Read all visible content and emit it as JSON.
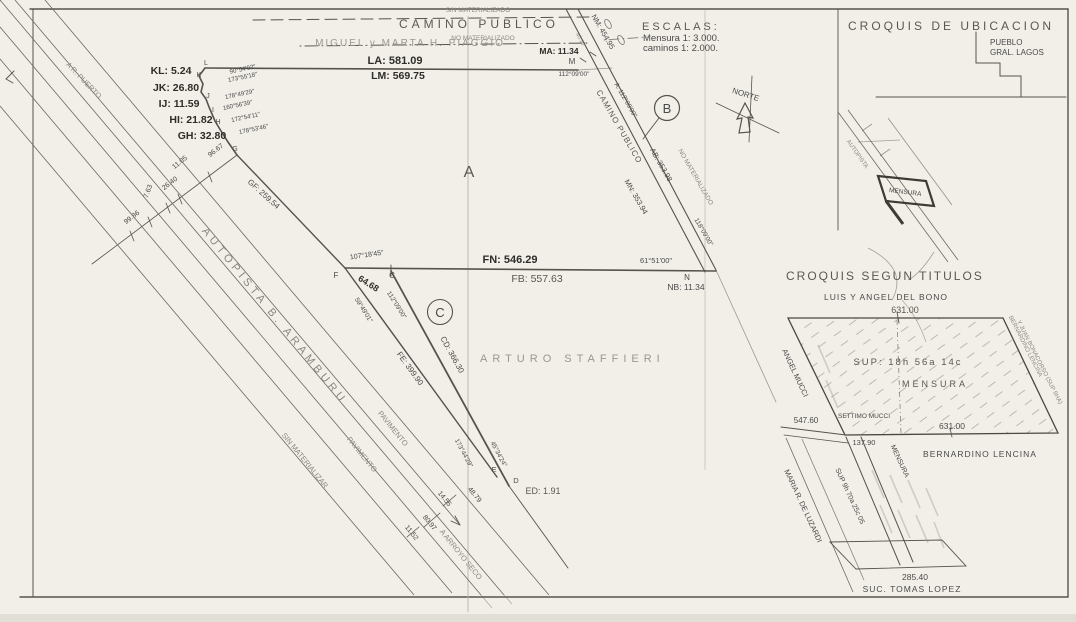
{
  "page": {
    "paper": "#f1efe8",
    "ink": "#4a4a4a",
    "faint_ink": "#8a887f",
    "bold_ink": "#2e2d2a"
  },
  "top": {
    "camino": "CAMINO PUBLICO",
    "mat_top": "S/N MATERIALIZADO",
    "mat_bottom": "NO MATERIALIZADO",
    "owner": "MIGUEL y MARTA H. PIAGGIO",
    "la": "LA: 581.09",
    "lm": "LM: 569.75",
    "ma": "MA: 11.34",
    "m": "M",
    "angle_m": "112°09'00\"",
    "d4010": "40.10"
  },
  "escalas": {
    "title": "ESCALAS:",
    "mensura": "Mensura 1: 3.000.",
    "caminos": "caminos 1: 2.000."
  },
  "norte": "NORTE",
  "road": {
    "name": "CAMINO PUBLICO",
    "nm": "NM: 454.95",
    "mn": "MN: 353.94",
    "ab": "AB: 353.98",
    "mat": "NO MATERIALIZADO",
    "angle_a": "A: 112°09'00\"",
    "angle_b": "118°09'00\"",
    "angle_n": "61°51'00\"",
    "b": "B",
    "n": "N",
    "nb": "NB: 11.34"
  },
  "west": {
    "kl": "KL: 5.24",
    "jk": "JK: 26.80",
    "ij": "IJ: 11.59",
    "hi": "HI: 21.82",
    "gh": "GH: 32.80",
    "letters": [
      "L",
      "K",
      "J",
      "I",
      "H",
      "G"
    ],
    "angles": [
      "90°54'02\"",
      "173°55'18\"",
      "178°49'29\"",
      "160°56'39\"",
      "172°54'11\"",
      "178°53'46\""
    ],
    "gf": "GF: 259.54",
    "puerto": "A R. PUERTO",
    "cross": [
      "96.67",
      "11.05",
      "26.40",
      "7.63",
      "99.86"
    ]
  },
  "autopista": {
    "name": "AUTOPISTA B. ARAMBURU",
    "pav1": "PAVIMENTO",
    "pav2": "PAVIMENTO",
    "sinmat": "SIN MATERIALIZAR",
    "arroyo": "A ARROYO SECO",
    "m1": "14.55",
    "m2": "80.97",
    "m3": "11.52"
  },
  "mid": {
    "fn": "FN: 546.29",
    "fb": "FB: 557.63",
    "f": "F",
    "c_pt": "C",
    "c64": "64.68",
    "angle_f": "107°18'45\"",
    "angle_fe": "59°49'01\"",
    "angle_c": "112°09'00\"",
    "fe": "FE: 399.90",
    "cd": "CD: 366.30",
    "parcel_a": "A",
    "parcel_b": "B",
    "parcel_c": "C",
    "staffieri": "ARTURO STAFFIERI"
  },
  "south": {
    "e": "E",
    "d": "D",
    "ed": "ED: 1.91",
    "m4879": "48.79",
    "angle_e": "173°44'29\"",
    "angle_d": "45°34'24\""
  },
  "ubicacion": {
    "title": "CROQUIS DE UBICACION",
    "pueblo1": "PUEBLO",
    "pueblo2": "GRAL. LAGOS",
    "autopista": "AUTOPISTA",
    "mensura": "MENSURA"
  },
  "titulos": {
    "title": "CROQUIS SEGUN TITULOS",
    "owner_top": "LUIS Y ANGEL DEL BONO",
    "top_len": "631.00",
    "sup": "SUP: 18h 56a 14c",
    "mensura": "MENSURA",
    "left_owner": "ANGEL MUCCI",
    "left_len": "547.60",
    "settimo": "SETTIMO MUCCI",
    "bot_len": "631.00",
    "corner": "137.90",
    "lencina": "BERNARDINO LENCINA",
    "right_note1": "BERNARDINO LENCINA",
    "right_note2": "Y JUAN BONACORSO (SUP 9HA)",
    "strip": "MENSURA",
    "sup9": "SUP 9h 70a 25c 05",
    "maria": "MARIA R. DE LUZARDI",
    "bottom_len": "285.40",
    "lopez": "SUC. TOMAS LOPEZ"
  }
}
